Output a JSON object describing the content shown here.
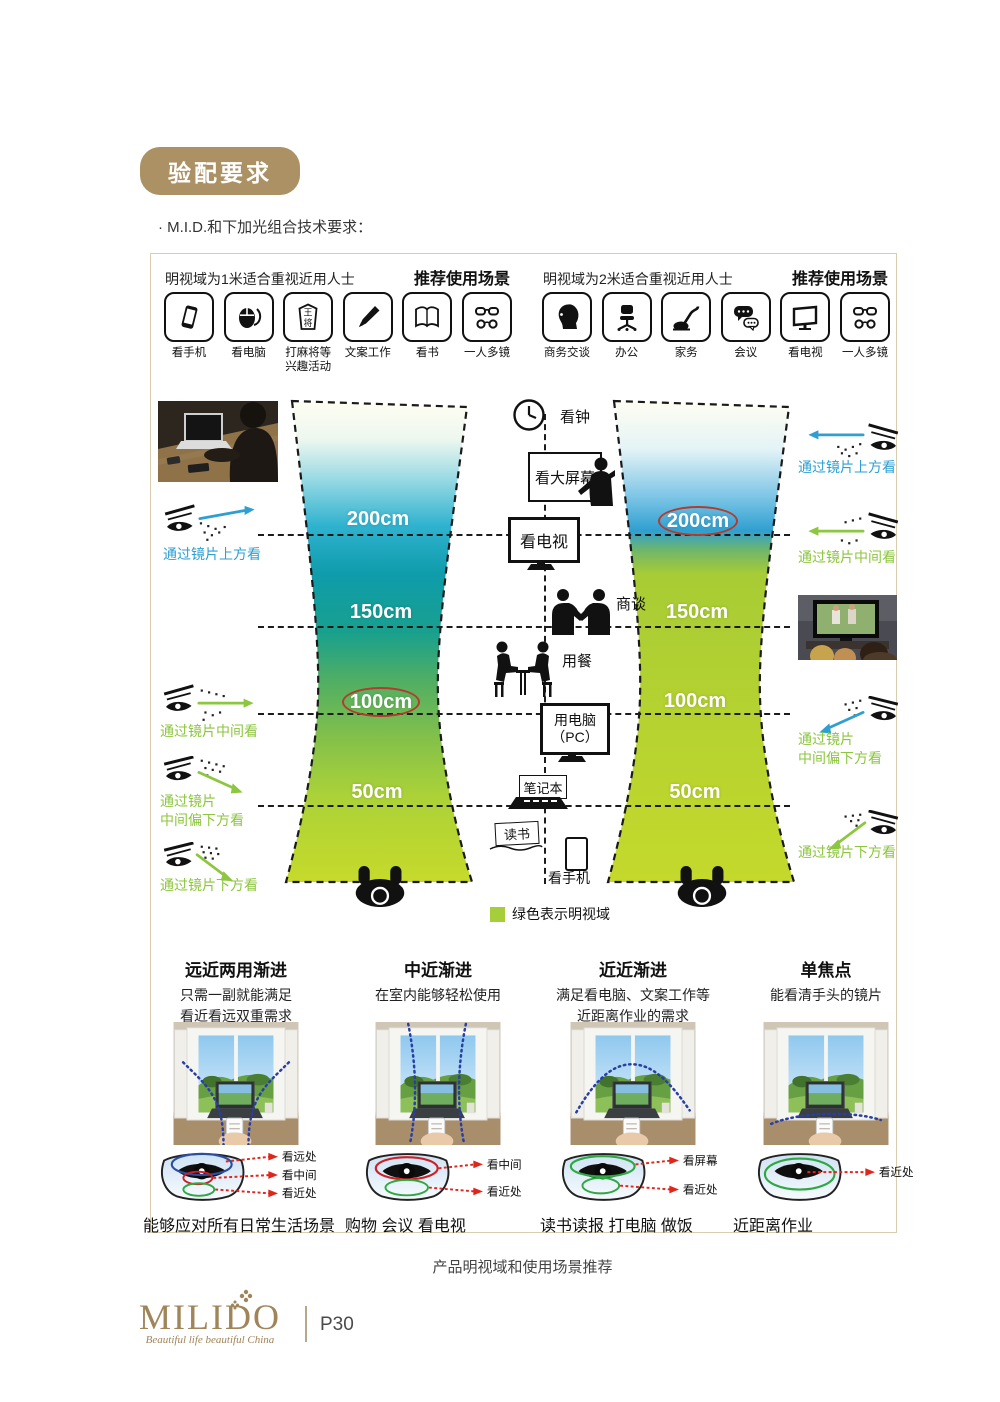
{
  "page": {
    "badge": "验配要求",
    "subtitle": "· M.I.D.和下加光组合技术要求：",
    "figure_caption": "产品明视域和使用场景推荐",
    "footer": {
      "logo": "MILIDO",
      "tagline": "Beautiful life beautiful China",
      "page_number": "P30"
    }
  },
  "panels": [
    {
      "header": "明视域为1米适合重视近用人士",
      "header_bold": "推荐使用场景",
      "items": [
        {
          "icon": "phone-icon",
          "label": "看手机"
        },
        {
          "icon": "mouse-icon",
          "label": "看电脑"
        },
        {
          "icon": "mahjong-icon",
          "label": "打麻将等",
          "label2": "兴趣活动",
          "tile_top": "王",
          "tile_bottom": "将"
        },
        {
          "icon": "pen-icon",
          "label": "文案工作"
        },
        {
          "icon": "book-icon",
          "label": "看书"
        },
        {
          "icon": "glasses-icon",
          "label": "一人多镜"
        }
      ]
    },
    {
      "header": "明视域为2米适合重视近用人士",
      "header_bold": "推荐使用场景",
      "items": [
        {
          "icon": "profile-icon",
          "label": "商务交谈"
        },
        {
          "icon": "office-chair-icon",
          "label": "办公"
        },
        {
          "icon": "vacuum-icon",
          "label": "家务"
        },
        {
          "icon": "chat-bubbles-icon",
          "label": "会议"
        },
        {
          "icon": "tv-icon",
          "label": "看电视"
        },
        {
          "icon": "glasses-icon",
          "label": "一人多镜"
        }
      ]
    }
  ],
  "diagram": {
    "left_distances": [
      "200cm",
      "150cm",
      "100cm",
      "50cm"
    ],
    "right_distances": [
      "200cm",
      "150cm",
      "100cm",
      "50cm"
    ],
    "highlighted_left": "100cm",
    "highlighted_right": "200cm",
    "center": {
      "clock": "看钟",
      "big_screen": "看大屏幕",
      "tv": "看电视",
      "negotiate": "商谈",
      "dining": "用餐",
      "pc_line1": "用电脑",
      "pc_line2": "（PC）",
      "laptop": "笔记本",
      "reading": "读书",
      "phone": "看手机"
    },
    "left_views": [
      {
        "label": "通过镜片上方看"
      },
      {
        "label": "通过镜片中间看"
      },
      {
        "label1": "通过镜片",
        "label2": "中间偏下方看"
      },
      {
        "label": "通过镜片下方看"
      }
    ],
    "right_views": [
      {
        "label": "通过镜片上方看"
      },
      {
        "label": "通过镜片中间看"
      },
      {
        "label1": "通过镜片",
        "label2": "中间偏下方看"
      },
      {
        "label": "通过镜片下方看"
      }
    ],
    "legend": "绿色表示明视域",
    "colors": {
      "gold": "#ab9164",
      "blue": "#2f9fd3",
      "green": "#8cc63e",
      "legend_green": "#a6ce39",
      "highlight_ring_red": "#b23c2e",
      "teal": "#0f9cab",
      "yellow_green": "#c6da2b",
      "arrow_red": "#e0251b"
    }
  },
  "lens_types": [
    {
      "title": "远近两用渐进",
      "desc1": "只需一副就能满足",
      "desc2": "看近看远双重需求",
      "label1": "看远处",
      "label2": "看中间",
      "label3": "看近处",
      "caption": "能够应对所有日常生活场景"
    },
    {
      "title": "中近渐进",
      "desc1": "在室内能够轻松使用",
      "desc2": "",
      "label1": "看中间",
      "label2": "看近处",
      "caption": "购物 会议 看电视"
    },
    {
      "title": "近近渐进",
      "desc1": "满足看电脑、文案工作等",
      "desc2": "近距离作业的需求",
      "label1": "看屏幕",
      "label2": "看近处",
      "caption": "读书读报 打电脑 做饭"
    },
    {
      "title": "单焦点",
      "desc1": "能看清手头的镜片",
      "desc2": "",
      "label1": "看近处",
      "caption": "近距离作业"
    }
  ]
}
